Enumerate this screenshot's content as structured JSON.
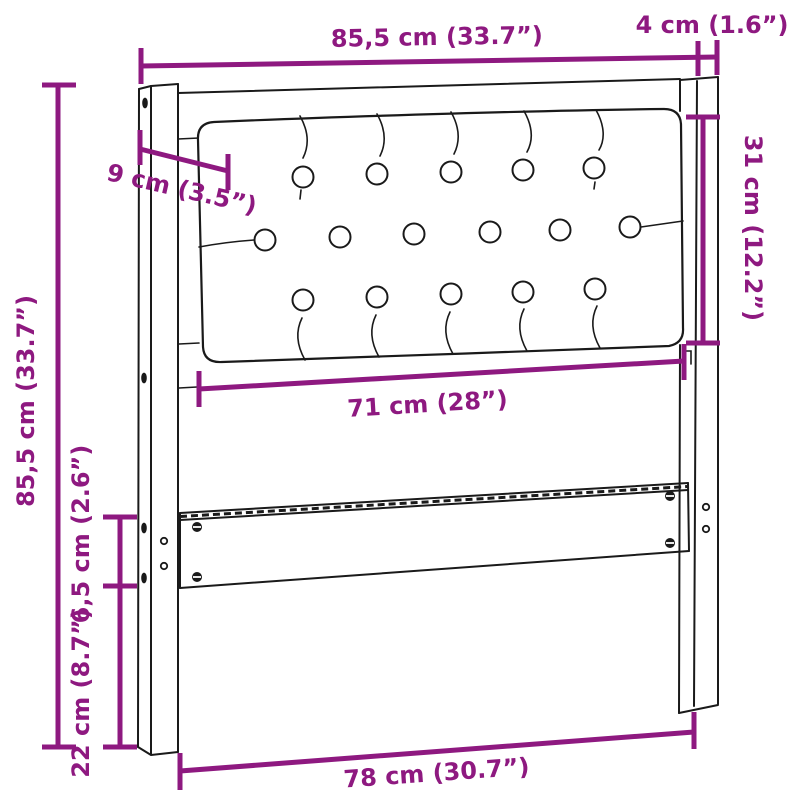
{
  "diagram": {
    "title": "Headboard dimension drawing",
    "colors": {
      "dimension": "#8E1980",
      "outline": "#1a1a1a",
      "background": "#ffffff"
    },
    "dimensions": {
      "frame_width": "85,5 cm (33.7”)",
      "post_depth": "4 cm (1.6”)",
      "cushion_inset": "9 cm (3.5”)",
      "cushion_height": "31 cm (12.2”)",
      "frame_height": "85,5 cm (33.7”)",
      "cushion_width": "71 cm (28”)",
      "rail_height": "6,5 cm (2.6”)",
      "leg_height": "22 cm (8.7”)",
      "inner_width": "78 cm (30.7”)"
    }
  }
}
